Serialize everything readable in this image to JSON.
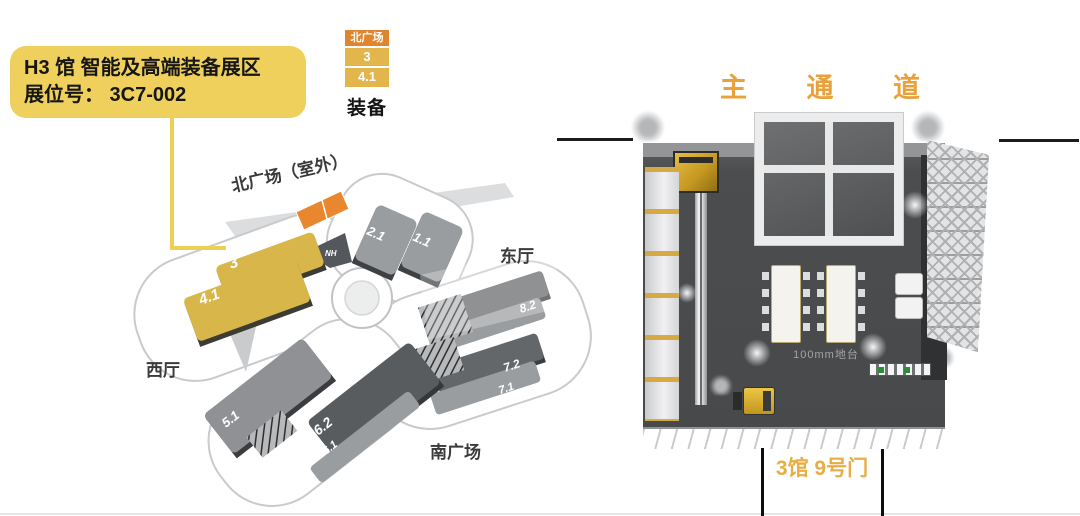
{
  "callout": {
    "title": "H3 馆 智能及高端装备展区",
    "booth_line": "展位号： 3C7-002"
  },
  "legend": {
    "north_plaza": "北广场",
    "hall_3": "3",
    "hall_4_1": "4.1",
    "caption": "装备"
  },
  "venue_map": {
    "area_labels": {
      "north_plaza_outdoor": "北广场（室外）",
      "east_hall": "东厅",
      "west_hall": "西厅",
      "south_plaza": "南广场"
    },
    "halls": {
      "h2_1": "2.1",
      "h1_1": "1.1",
      "nh": "NH",
      "h8_2": "8.2",
      "h8_1": "8.1",
      "h7_2": "7.2",
      "h7_1": "7.1",
      "h5_1": "5.1",
      "h6_2": "6.2",
      "h6_1": "6.1",
      "h3": "3",
      "h4_1": "4.1"
    }
  },
  "booth_render": {
    "main_aisle_label": "主 通 道",
    "platform_label": "100mm地台",
    "gate_label": "3馆 9号门"
  },
  "colors": {
    "callout_yellow": "#F0D05C",
    "highlight_hall_yellow": "#D9B64A",
    "plaza_orange": "#E8872D",
    "aisle_text_orange": "#E9A23B",
    "gate_text_yellow": "#E8AE45"
  }
}
